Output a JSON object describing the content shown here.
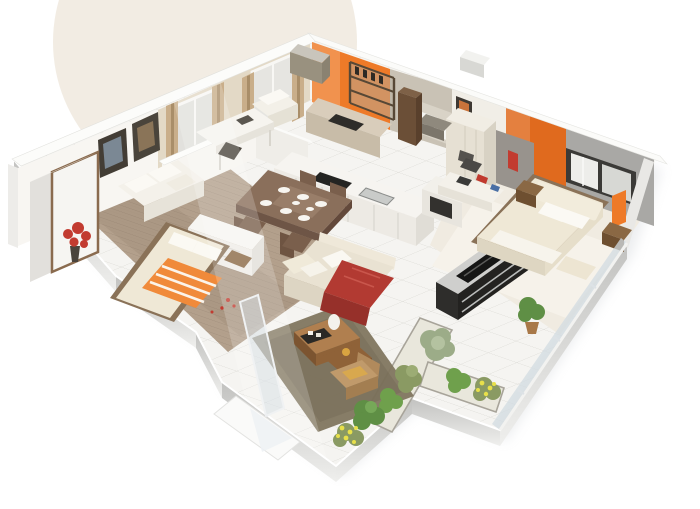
{
  "image": {
    "kind": "3d-isometric-floor-plan-render",
    "background": "#ffffff",
    "watermark": "soft beige circle in the top-left corner"
  },
  "palette": {
    "watermark_beige": "#E8DCCC",
    "wall_white": "#F8F6F2",
    "wall_beige": "#E3D9C6",
    "wall_grey": "#A9A8A5",
    "wall_grey_light": "#C9C2B5",
    "accent_orange": "#EE7A28",
    "accent_orange_deep": "#E06A1E",
    "floor_tile": "#F5F4F1",
    "grout": "#DBDAD5",
    "wood_floor": "#B3A08C",
    "master_carpet": "#F0EBE1",
    "dining_wood": "#8A6F5B",
    "sofa_cream": "#E9E2D2",
    "throw_red": "#B23A32",
    "throw_red_dark": "#96302A",
    "rug_dark": "#81765F",
    "tv_unit_dark": "#232220",
    "tv_top_silver": "#CFCFCD",
    "coffee_wood": "#B07F4F",
    "coffee_wood_dark": "#8F6238",
    "armchair_tan": "#C09A6B",
    "curtain_tan": "#C9AE8A",
    "glass_blue": "#CBD6DD",
    "leaf_green": "#6FA04C",
    "leaf_olive": "#8A9A63",
    "leaf_grey_green": "#9CAC88",
    "leaf_lush": "#5F8F45",
    "flower_yellow": "#E8E04A",
    "flower_red": "#C23B30",
    "bed_orange_duvet": "#F08A3A",
    "bed_cream": "#EFE8D6",
    "nightstand_wood": "#8A6844",
    "planter_bed": "#E9E7DC"
  },
  "rooms": [
    {
      "name": "study lounge",
      "position": "top-left",
      "features": [
        "two windows with tan curtains",
        "white armchair",
        "writing desk",
        "dark chair"
      ]
    },
    {
      "name": "left bedroom",
      "position": "left",
      "features": [
        "double bed with orange striped duvet",
        "white settee with cushions",
        "wardrobe",
        "red flower vase",
        "two picture frames",
        "wood plank floor"
      ]
    },
    {
      "name": "kitchen",
      "position": "top-center",
      "features": [
        "orange accent wall",
        "white island counter",
        "dark cooktop",
        "tall fridge",
        "open shelving with bottles"
      ]
    },
    {
      "name": "dining area",
      "position": "center",
      "features": [
        "brown dining table set with white dishes",
        "dark wood chairs",
        "white sideboard",
        "red petals on floor"
      ]
    },
    {
      "name": "hallway and bath",
      "position": "top-right-center",
      "features": [
        "framed picture on wall",
        "white fixtures",
        "grey partition walls",
        "console bench"
      ]
    },
    {
      "name": "living room",
      "position": "center-bottom",
      "features": [
        "cream sofa with red throw",
        "dark media console with TV",
        "wooden nesting coffee tables",
        "dark shag rug",
        "tan armchair",
        "glass partition"
      ]
    },
    {
      "name": "master bedroom",
      "position": "right",
      "features": [
        "orange accent wall",
        "sliding window in grey wall",
        "cream double bed with bolster pillows",
        "nightstands",
        "white wardrobe",
        "desk with office chair"
      ]
    },
    {
      "name": "terrace",
      "position": "bottom-right",
      "features": [
        "white floor tiles",
        "L-shaped planting strip",
        "green shrubs",
        "yellow flowering plants",
        "potted plant",
        "glass balustrade"
      ]
    }
  ]
}
